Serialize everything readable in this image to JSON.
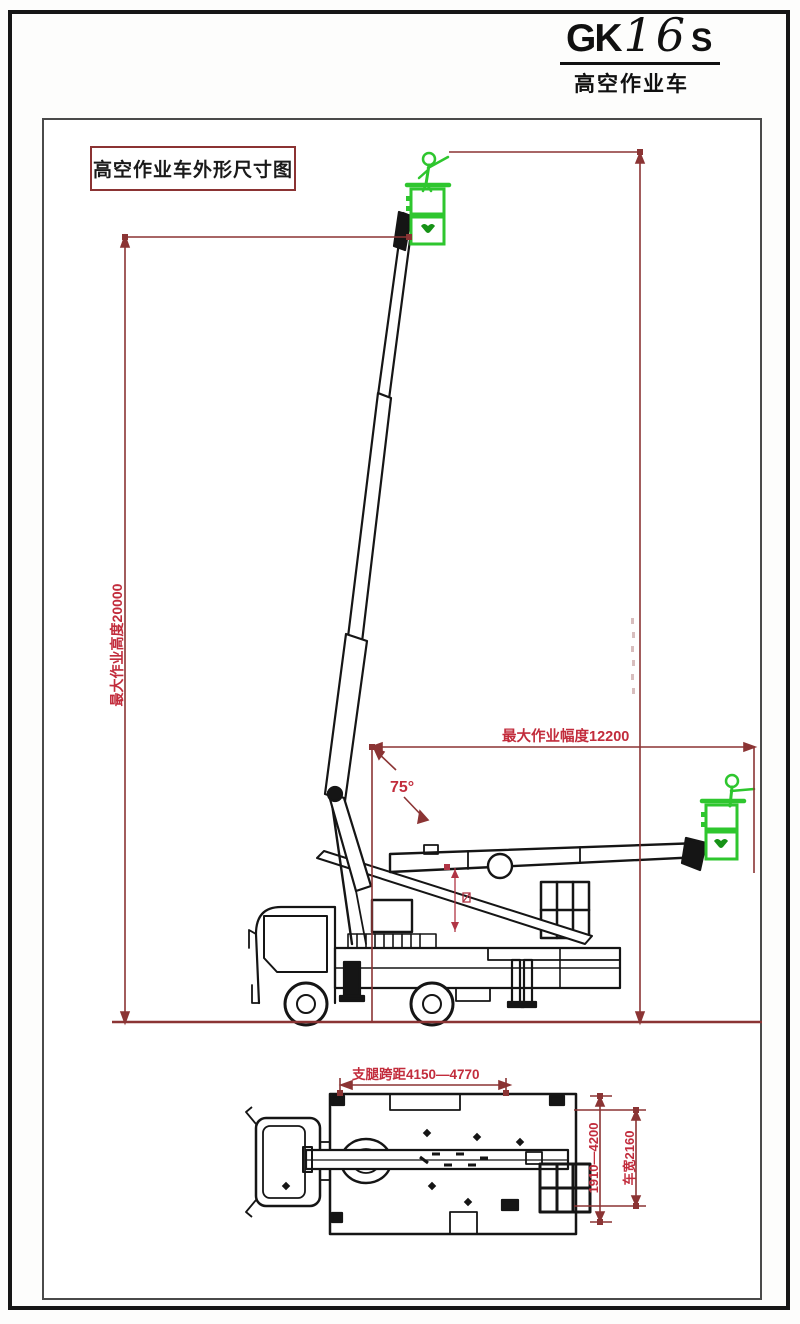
{
  "logo": {
    "prefix": "GK",
    "number": "16",
    "suffix": "S",
    "subtitle": "高空作业车"
  },
  "drawing": {
    "title": "高空作业车外形尺寸图",
    "side_view": {
      "max_height_label": "最大作业高度20000",
      "max_outreach_label": "最大作业幅度12200",
      "boom_angle_label": "75°"
    },
    "plan_view": {
      "outrigger_span_label": "支腿跨距4150—4770",
      "outrigger_width_label": "1910—4200",
      "vehicle_width_label": "车宽2160"
    }
  },
  "colors": {
    "dimension_line": "#8b3434",
    "dimension_text": "#c22c3c",
    "drawing_ink": "#151515",
    "figure_green": "#2ec62e",
    "logo_green": "#169216",
    "title_border": "#8b3333",
    "frame": "#4a4a4a"
  }
}
